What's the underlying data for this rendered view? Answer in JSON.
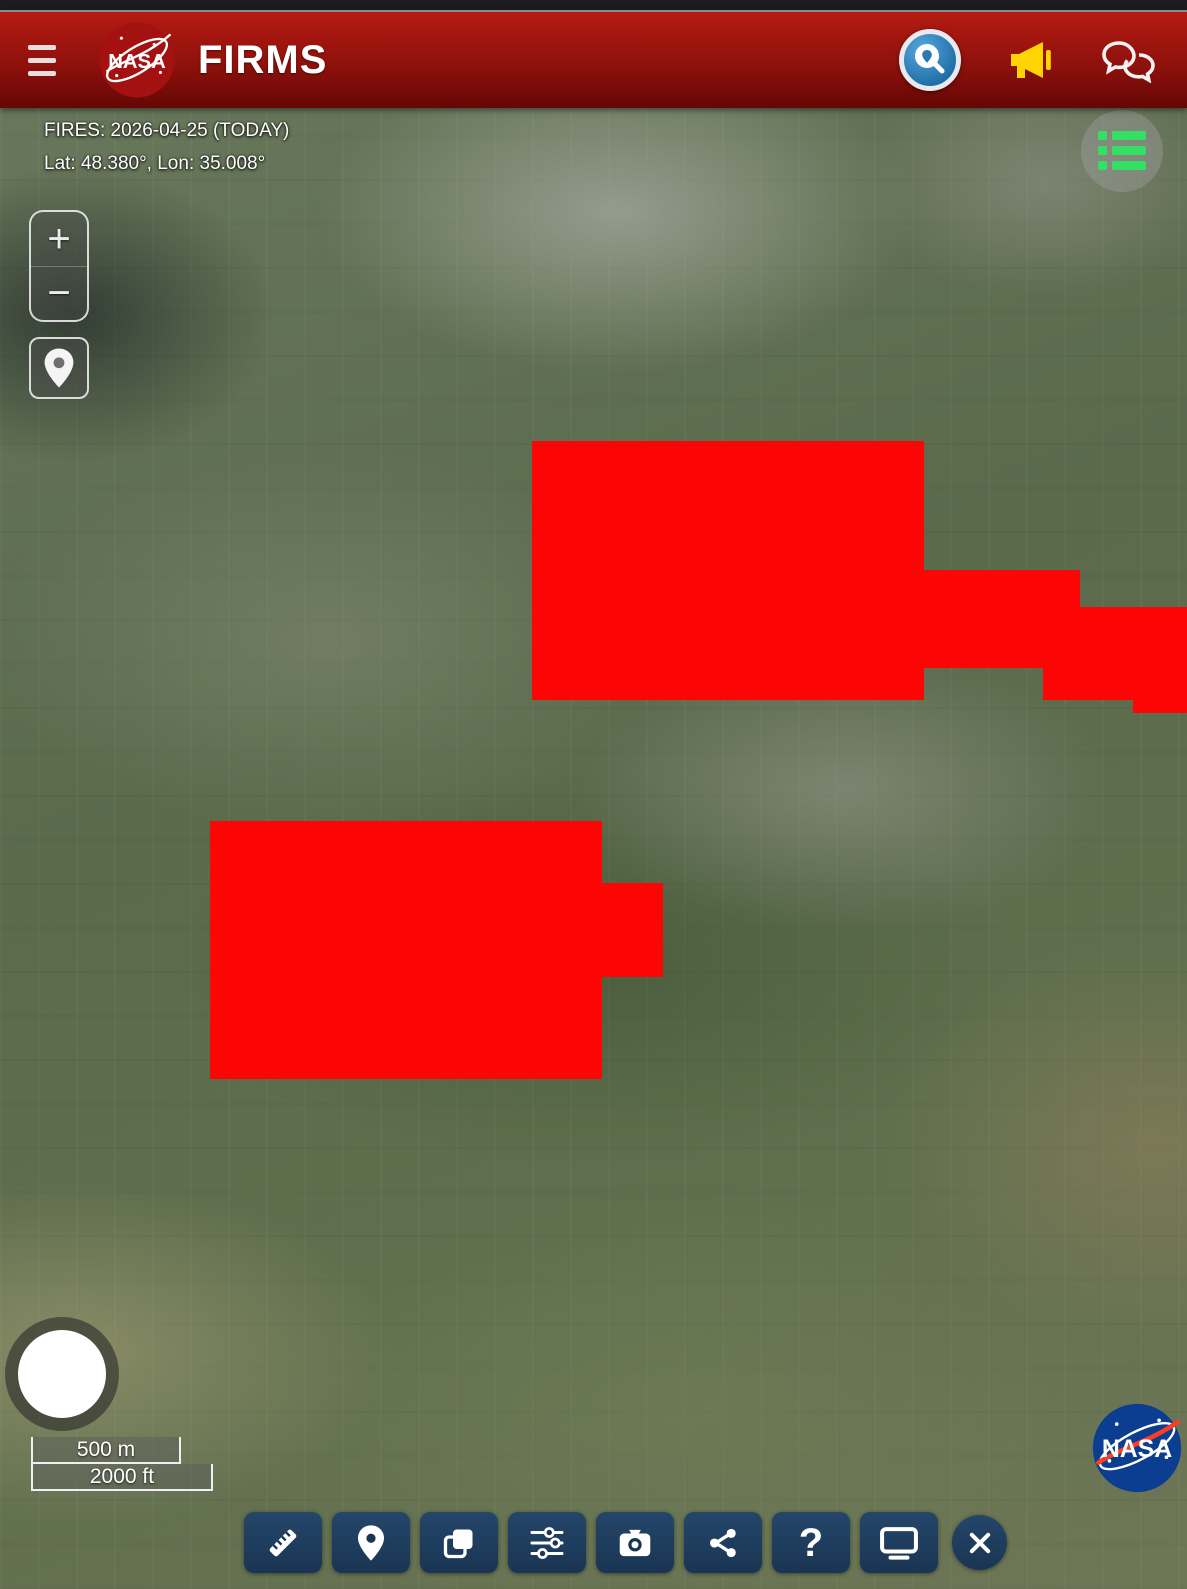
{
  "header": {
    "title": "FIRMS",
    "logo_text": "NASA",
    "icons": {
      "menu": "hamburger-icon",
      "search": "search-location-icon",
      "announcements": "megaphone-icon",
      "feedback": "chat-bubbles-icon"
    }
  },
  "map": {
    "status_line1": "FIRES: 2026-04-25 (TODAY)",
    "status_line2": "Lat: 48.380°, Lon: 35.008°",
    "zoom_in_label": "+",
    "zoom_out_label": "−",
    "scale": {
      "metric": "500 m",
      "imperial": "2000 ft"
    },
    "fire_color": "#fb0505",
    "fire_overlays": [
      {
        "x": 532,
        "y": 333,
        "w": 392,
        "h": 259
      },
      {
        "x": 924,
        "y": 462,
        "w": 156,
        "h": 98
      },
      {
        "x": 1043,
        "y": 560,
        "w": 37,
        "h": 32
      },
      {
        "x": 1080,
        "y": 499,
        "w": 107,
        "h": 93
      },
      {
        "x": 1133,
        "y": 592,
        "w": 54,
        "h": 13
      },
      {
        "x": 210,
        "y": 713,
        "w": 392,
        "h": 258
      },
      {
        "x": 602,
        "y": 775,
        "w": 61,
        "h": 94
      }
    ],
    "controls": {
      "layers_list": "list-icon",
      "locate": "location-pin-icon",
      "compass": "compass-circle"
    }
  },
  "toolbar": {
    "help_glyph": "?",
    "buttons": [
      {
        "name": "measure",
        "icon": "ruler-icon"
      },
      {
        "name": "location",
        "icon": "map-pin-icon"
      },
      {
        "name": "layers",
        "icon": "layers-icon"
      },
      {
        "name": "adjustments",
        "icon": "sliders-icon"
      },
      {
        "name": "screenshot",
        "icon": "camera-icon"
      },
      {
        "name": "share",
        "icon": "share-icon"
      },
      {
        "name": "help",
        "icon": "question-icon"
      },
      {
        "name": "display",
        "icon": "monitor-icon"
      },
      {
        "name": "close",
        "icon": "close-icon"
      }
    ]
  },
  "branding": {
    "watermark": "NASA"
  }
}
